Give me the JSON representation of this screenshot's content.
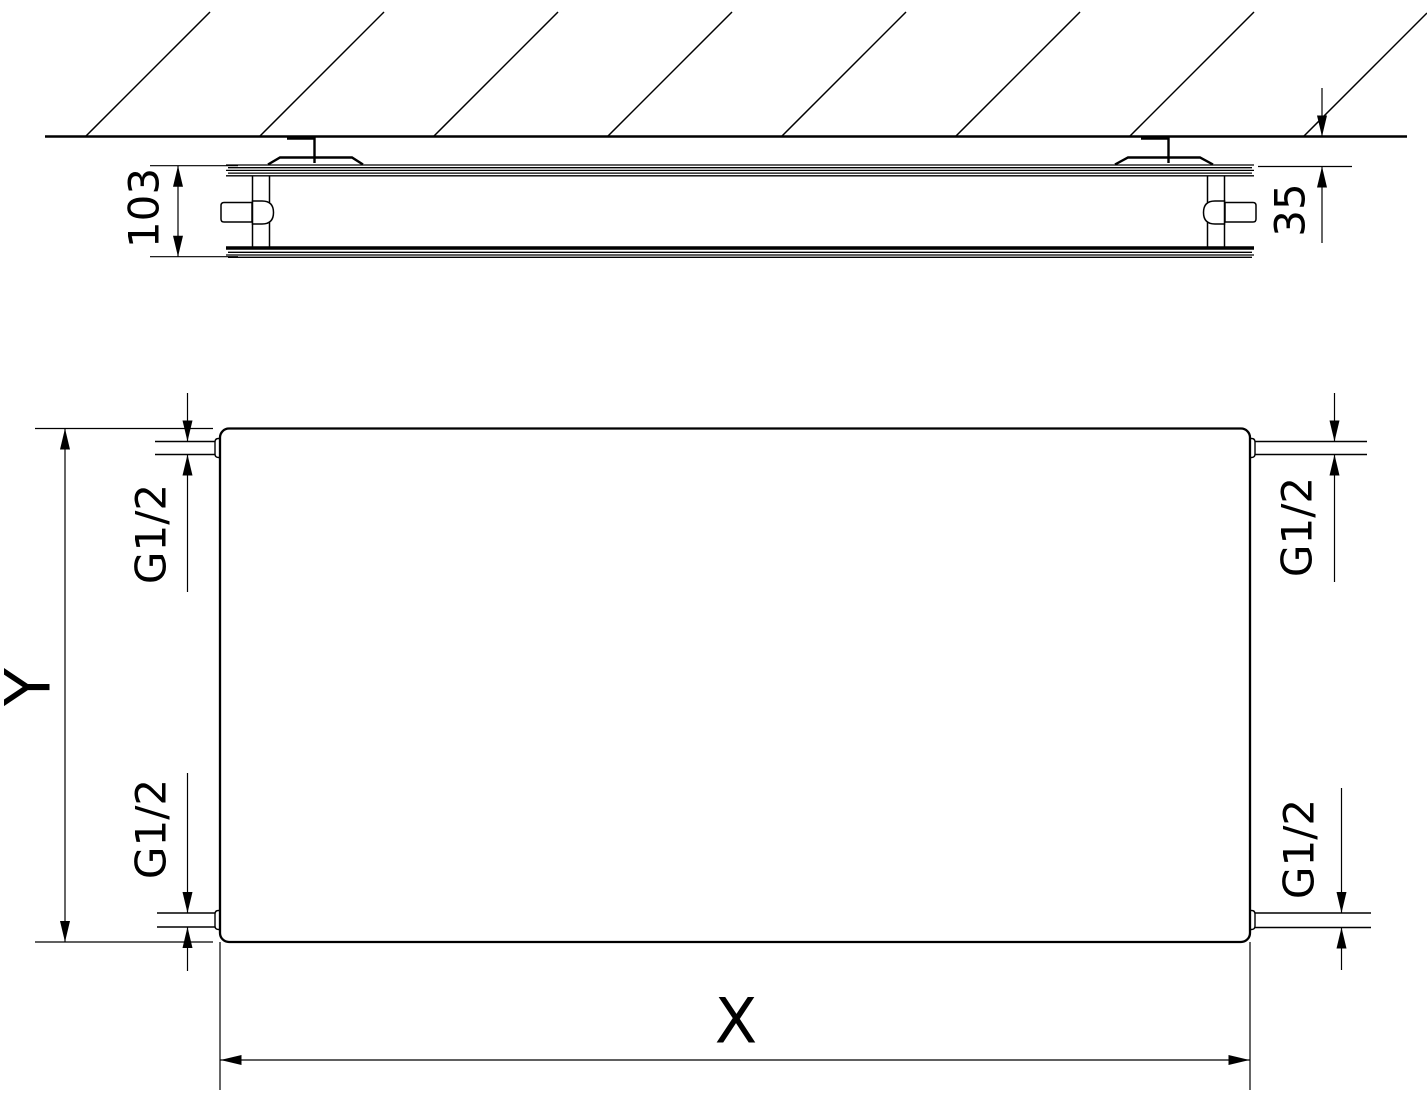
{
  "drawing": {
    "colors": {
      "line": "#000000",
      "background": "#ffffff"
    },
    "plan_view": {
      "depth_label": "103",
      "wall_distance_label": "35"
    },
    "front_view": {
      "height_label": "Y",
      "width_label": "X",
      "connections": {
        "top_left": "G1/2",
        "top_right": "G1/2",
        "bottom_left": "G1/2",
        "bottom_right": "G1/2"
      }
    }
  }
}
